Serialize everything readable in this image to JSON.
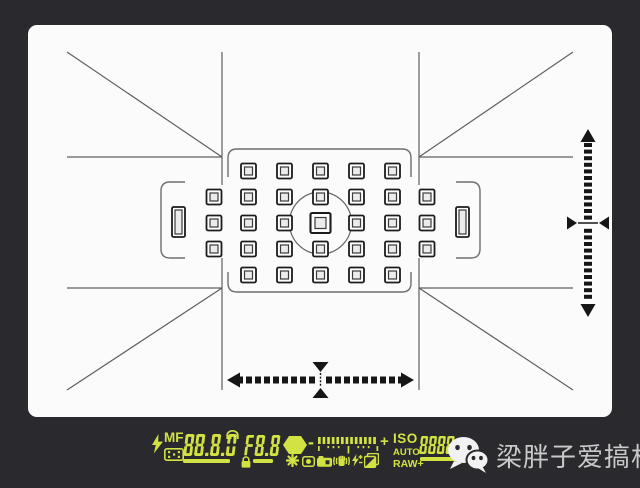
{
  "colors": {
    "background": "#2a292d",
    "screen": "#fbfbfb",
    "frame_line": "#5f5f5f",
    "bracket": "#6e6e6e",
    "af_stroke": "#1c1c1c",
    "af_inner_fill": "#ececec",
    "meter_ink": "#161616",
    "lcd": "#d3e243",
    "watermark_text": "#c9c9c9"
  },
  "lcd": {
    "flash_icon": "flash-bolt-icon",
    "mf_label": "MF",
    "shutter_display": "88.8.0",
    "aperture_display": "F8.8",
    "minus_label": "-",
    "plus_label": "+",
    "iso_label": "ISO",
    "auto_label": "AUTO",
    "raw_label": "RAW+",
    "iso_value_display": "8888"
  },
  "watermark": {
    "text": "梁胖子爱搞机",
    "icon": "wechat-icon"
  },
  "viewfinder": {
    "af_grid": {
      "cols": [
        186,
        220.5,
        256.5,
        292.5,
        328.5,
        364.5,
        399
      ],
      "rows": [
        146,
        172,
        198,
        224,
        250
      ],
      "center_col": 3,
      "center_row": 2,
      "point_size": 15,
      "point_inner": 8,
      "center_size": 20,
      "center_inner": 11,
      "tall_points": [
        {
          "cx": 150.5,
          "cy": 197
        },
        {
          "cx": 434.5,
          "cy": 197
        }
      ],
      "tall_size": {
        "w": 13,
        "h": 30,
        "iw": 7,
        "ih": 24
      }
    },
    "spot_circle": {
      "cx": 292.5,
      "cy": 198,
      "r": 31
    },
    "v_meter": {
      "x": 560,
      "top": 118,
      "bottom": 277,
      "dash_w": 8,
      "dash_h": 4,
      "gap": 2.6,
      "center_y": 198
    },
    "h_meter": {
      "y": 355,
      "runs": [
        [
          209,
          287
        ],
        [
          298,
          376
        ]
      ],
      "dash_w": 6,
      "dash_h": 7,
      "step": 9,
      "center_x": 292.5
    },
    "lcd_meter": {
      "dash_count": 13,
      "dash_step": 4.6,
      "dash_w": 2.7,
      "dash_h": 7,
      "ticks": [
        [
          0,
          5
        ],
        [
          9.4,
          2.2
        ],
        [
          14.6,
          2.2
        ],
        [
          19.8,
          2.2
        ],
        [
          29.6,
          7.5
        ],
        [
          39.4,
          2.2
        ],
        [
          44.6,
          2.2
        ],
        [
          49.8,
          2.2
        ],
        [
          58.5,
          5
        ]
      ]
    }
  }
}
